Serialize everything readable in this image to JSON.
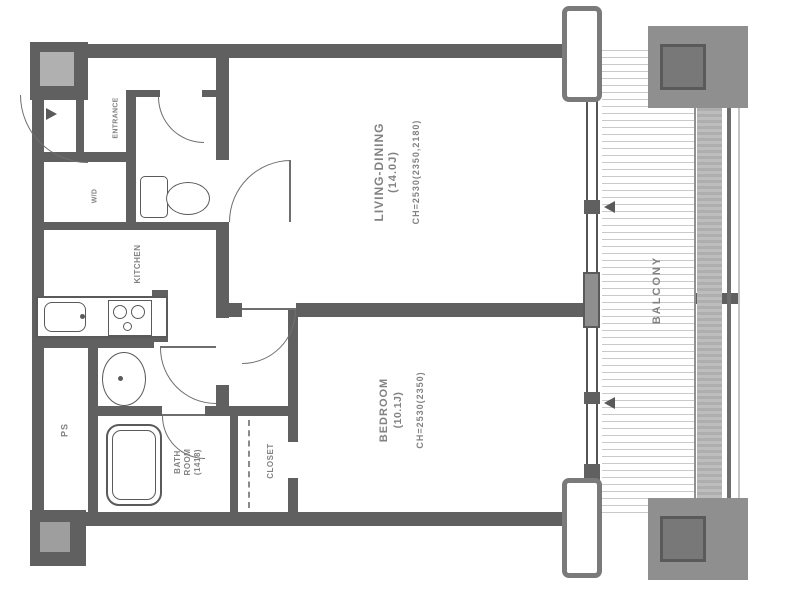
{
  "floor_plan": {
    "rooms": {
      "living_dining": {
        "name": "LIVING-DINING",
        "size": "(14.0J)",
        "ceiling": "CH=2530(2350,2180)"
      },
      "bedroom": {
        "name": "BEDROOM",
        "size": "(10.1J)",
        "ceiling": "CH=2530(2350)"
      },
      "balcony": {
        "name": "BALCONY"
      },
      "kitchen": {
        "name": "KITCHEN"
      },
      "entrance": {
        "name": "ENTRANCE"
      },
      "bathroom": {
        "name_line1": "BATH",
        "name_line2": "ROOM",
        "size": "(1418)"
      },
      "closet": {
        "name": "CLOSET"
      },
      "washer_dryer": {
        "name": "W/D"
      },
      "pipe_space": {
        "name": "PS"
      }
    },
    "colors": {
      "wall": "#606060",
      "label_text": "#828282",
      "balcony_hatch": "#c9c9c9"
    }
  }
}
